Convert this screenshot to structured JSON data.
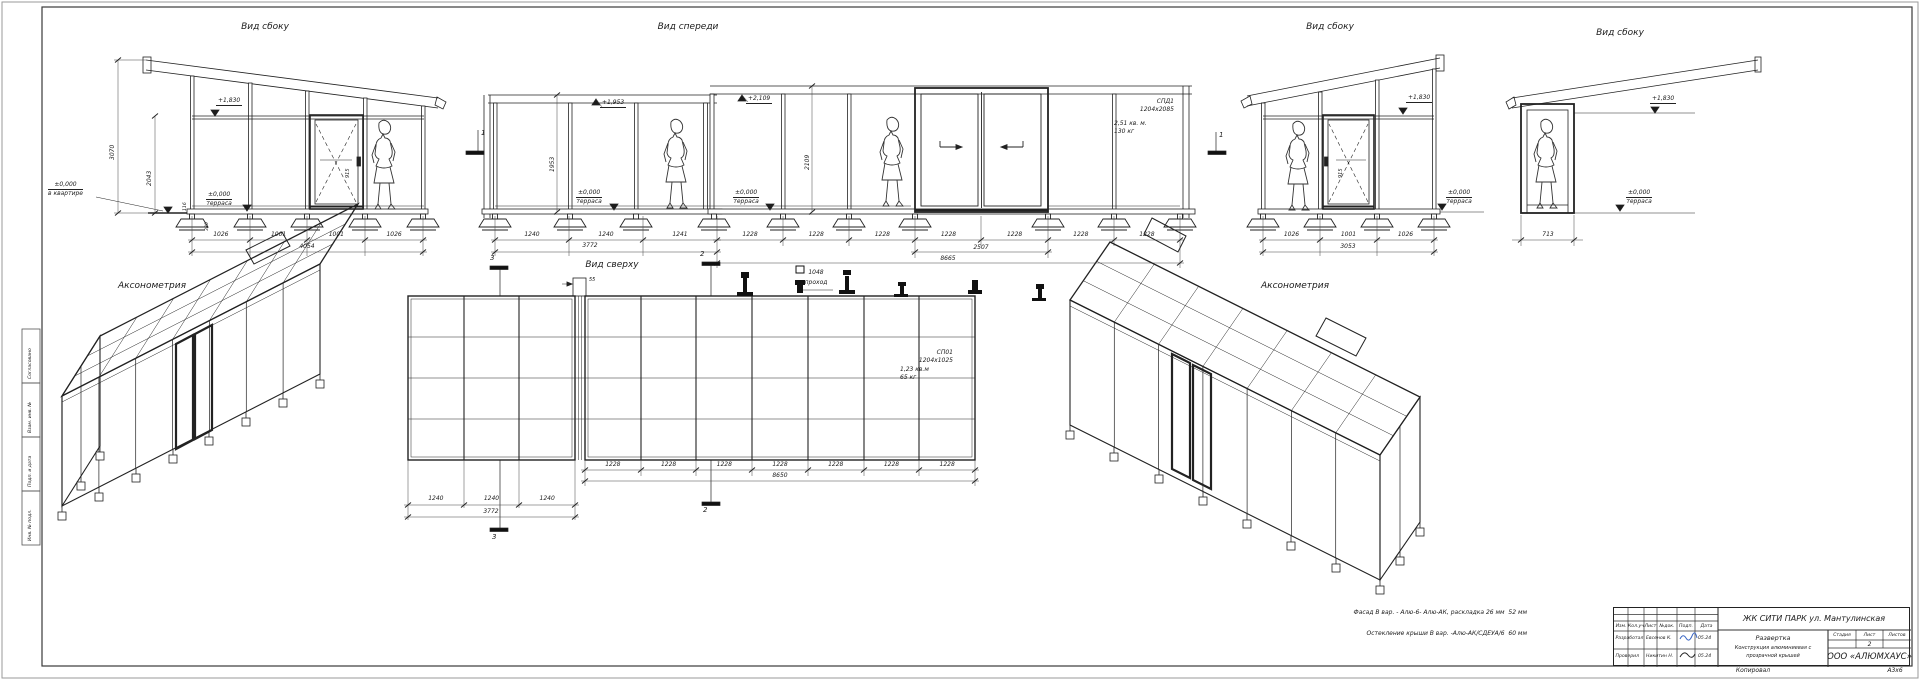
{
  "titles": {
    "view1": "Вид сбоку",
    "front": "Вид спереди",
    "view4": "Вид сбоку",
    "view5": "Вид сбоку",
    "axon_left": "Аксонометрия",
    "plan": "Вид сверху",
    "axon_right": "Аксонометрия"
  },
  "view1": {
    "elev_roof": "+1,830",
    "elev_terrace": "±0,000",
    "terrace_word": "терраса",
    "elev_apt": "±0,000",
    "apt_word": "в квартире",
    "h_total": "3070",
    "h_inner": "2043",
    "h_116": "116",
    "h_380": "380",
    "door_dim": "915",
    "dims": [
      "1026",
      "1001",
      "1001",
      "1026"
    ],
    "total": "4054"
  },
  "front": {
    "elev_left": "+1,953",
    "dim_left_h": "1953",
    "elev_right": "+2,109",
    "dim_right_h": "2109",
    "terrace": "±0,000",
    "terrace_word": "терраса",
    "section": "1",
    "panel": {
      "name": "СПД1",
      "size": "1204х2085",
      "area": "2,51 кв. м.",
      "weight": "130 кг"
    },
    "dims_left": [
      "1240",
      "1240",
      "1241"
    ],
    "total_left": "3772",
    "dims_right": [
      "1228",
      "1228",
      "1228",
      "1228",
      "1228",
      "1228",
      "1228"
    ],
    "door_width": "2507",
    "total_right": "8665"
  },
  "view4": {
    "elev_roof": "+1,830",
    "terrace": "±0,000",
    "terrace_word": "терраса",
    "door_dim": "915",
    "dims": [
      "1026",
      "1001",
      "1026"
    ],
    "total": "3053"
  },
  "view5": {
    "elev_roof": "+1,830",
    "terrace": "±0,000",
    "terrace_word": "терраса",
    "dim": "713"
  },
  "plan": {
    "sec2": "2",
    "sec3": "3",
    "gap": "55",
    "pass_dim": "1048",
    "pass_word": "проход",
    "panel": {
      "name": "СП01",
      "size": "1204х1025",
      "area": "1,23 кв.м",
      "weight": "65 кг"
    },
    "dims": [
      "1228",
      "1228",
      "1228",
      "1228",
      "1228",
      "1228",
      "1228"
    ],
    "total": "8650",
    "dims_left": [
      "1240",
      "1240",
      "1240"
    ],
    "total_left": "3772"
  },
  "notes": {
    "line1": "Фасад В вар. - Алю-6- Алю-АК, раскладка 26 мм  52 мм",
    "line2": "Остекление крыши В вар. -Алю-АК/СДЕУА/6  60 мм"
  },
  "stamp": {
    "project": "ЖК СИТИ ПАРК ул. Мантулинская",
    "cols": [
      "Изм.",
      "Кол.уч",
      "Лист",
      "№док.",
      "Подп.",
      "Дата"
    ],
    "row1_label": "Разработал",
    "row1_name": "Евсенов К.",
    "row1_date": "05.24",
    "row2_label": "Проверил",
    "row2_name": "Никитин Н.",
    "row2_date": "05.24",
    "doc1": "Развертка",
    "doc2": "Конструкция алюминиевая с",
    "doc3": "прозрачной крышей",
    "stage_label": "Стадия",
    "sheet_label": "Лист",
    "sheets_label": "Листов",
    "sheet_num": "2",
    "company": "ООО «АЛЮМХАУС»",
    "copied": "Копировал",
    "format": "А3х6"
  },
  "strip": {
    "labels": [
      "Согласовано",
      "Взам. инв. №",
      "Подп. и дата",
      "Инв. № подл."
    ]
  }
}
